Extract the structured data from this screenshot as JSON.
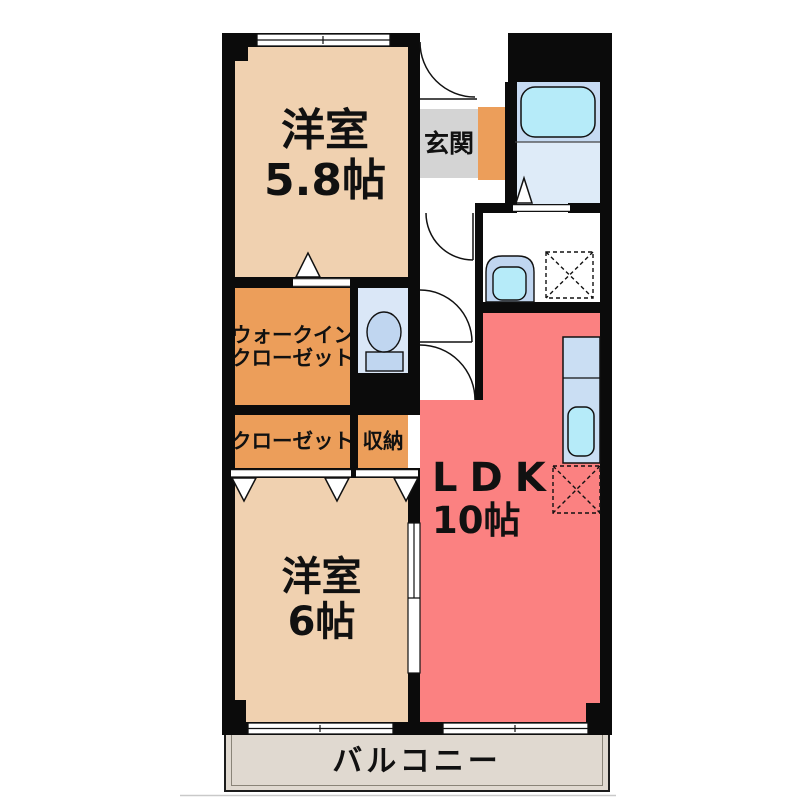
{
  "rooms": {
    "western_top": {
      "name": "洋室",
      "size": "5.8帖"
    },
    "entrance": {
      "name": "玄関"
    },
    "walk_in_closet": {
      "name_line1": "ウォークイン",
      "name_line2": "クローゼット"
    },
    "closet": {
      "name": "クローゼット"
    },
    "storage": {
      "name": "収納"
    },
    "western_bottom": {
      "name": "洋室",
      "size": "6帖"
    },
    "ldk": {
      "name": "LDK",
      "size": "10帖"
    },
    "balcony": {
      "name": "バルコニー"
    }
  },
  "colors": {
    "wall": "#0b0b0b",
    "room_peach": "#F0D1B0",
    "room_orange": "#EC9E5A",
    "room_pink": "#FB8181",
    "entrance_gray": "#D4D4D4",
    "balcony_bg": "#E0D9D0",
    "bath_upper": "#C6DAF2",
    "bath_lower": "#DEEBF8",
    "toilet_floor": "#DAE7F7",
    "fixture_blue": "#C0D6F0",
    "fixture_cyan": "#B6EBF9",
    "kitchen_blue": "#CADEF3",
    "ink": "#111111"
  }
}
